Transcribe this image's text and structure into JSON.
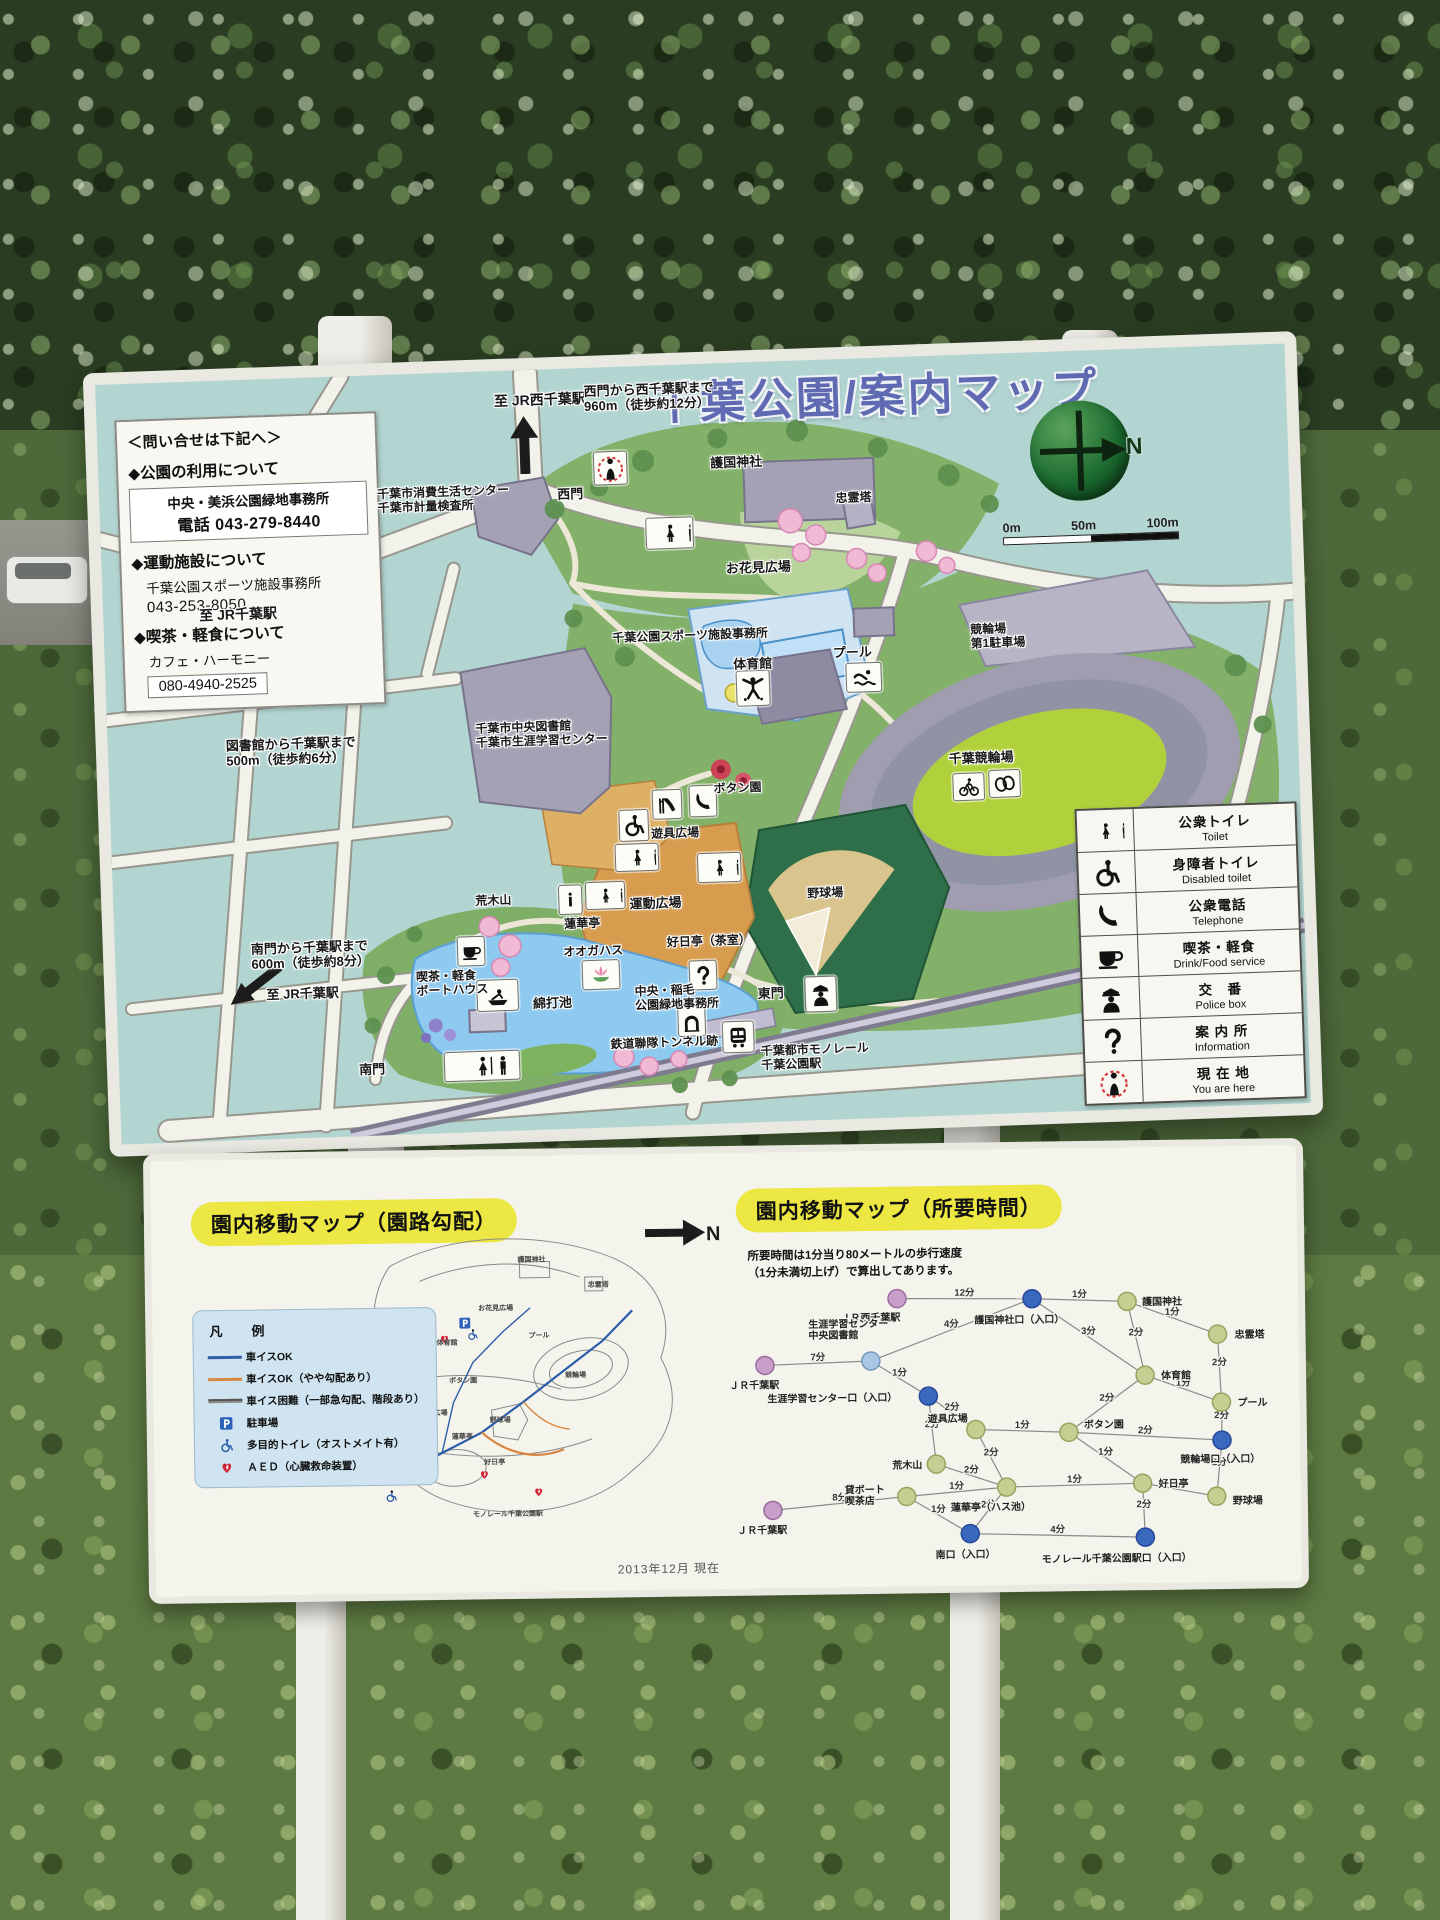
{
  "sign_title": "千葉公園/案内マップ",
  "compass_n": "N",
  "scale": [
    "0m",
    "50m",
    "100m"
  ],
  "contact": {
    "heading": "＜問い合せは下記へ＞",
    "s1_title": "◆公園の利用について",
    "s1_line1": "中央・美浜公園緑地事務所",
    "s1_line2": "電話 043-279-8440",
    "s2_title": "◆運動施設について",
    "s2_line1": "千葉公園スポーツ施設事務所",
    "s2_line2": "043-253-8050",
    "s3_title": "◆喫茶・軽食について",
    "s3_line1": "カフェ・ハーモニー",
    "s3_line2": "080-4940-2525"
  },
  "map_labels": [
    {
      "t": "至 JR西千葉駅",
      "x": 398,
      "y": 22,
      "fs": 14
    },
    {
      "t": "西門から西千葉駅まで\n960m（徒歩約12分）",
      "x": 488,
      "y": 16,
      "fs": 13
    },
    {
      "t": "西門",
      "x": 458,
      "y": 118,
      "fs": 13
    },
    {
      "t": "護国神社",
      "x": 612,
      "y": 92,
      "fs": 13
    },
    {
      "t": "忠霊塔",
      "x": 736,
      "y": 132,
      "fs": 12
    },
    {
      "t": "お花見広場",
      "x": 624,
      "y": 198,
      "fs": 13
    },
    {
      "t": "千葉市消費生活センター\n千葉市計量検査所",
      "x": 278,
      "y": 112,
      "fs": 12
    },
    {
      "t": "千葉公園スポーツ施設事務所",
      "x": 508,
      "y": 264,
      "fs": 12
    },
    {
      "t": "体育館",
      "x": 628,
      "y": 294,
      "fs": 13
    },
    {
      "t": "プール",
      "x": 728,
      "y": 286,
      "fs": 13
    },
    {
      "t": "競輪場\n第1駐車場",
      "x": 866,
      "y": 268,
      "fs": 12
    },
    {
      "t": "千葉競輪場",
      "x": 840,
      "y": 396,
      "fs": 13
    },
    {
      "t": "ボタン園",
      "x": 604,
      "y": 418,
      "fs": 12
    },
    {
      "t": "遊具広場",
      "x": 540,
      "y": 461,
      "fs": 12
    },
    {
      "t": "運動広場",
      "x": 516,
      "y": 530,
      "fs": 13
    },
    {
      "t": "野球場",
      "x": 694,
      "y": 526,
      "fs": 12
    },
    {
      "t": "荒木山",
      "x": 362,
      "y": 522,
      "fs": 12
    },
    {
      "t": "蓮華亭",
      "x": 450,
      "y": 548,
      "fs": 12
    },
    {
      "t": "オオガハス",
      "x": 448,
      "y": 576,
      "fs": 12
    },
    {
      "t": "好日亭（茶室）",
      "x": 552,
      "y": 570,
      "fs": 12
    },
    {
      "t": "喫茶・軽食\nボートハウス",
      "x": 300,
      "y": 596,
      "fs": 12
    },
    {
      "t": "綿打池",
      "x": 416,
      "y": 626,
      "fs": 13
    },
    {
      "t": "中央・稲毛\n公園緑地事務所",
      "x": 518,
      "y": 618,
      "fs": 12
    },
    {
      "t": "東門",
      "x": 641,
      "y": 624,
      "fs": 13
    },
    {
      "t": "鉄道聯隊トンネル跡",
      "x": 492,
      "y": 670,
      "fs": 12
    },
    {
      "t": "千葉都市モノレール\n千葉公園駅",
      "x": 642,
      "y": 682,
      "fs": 12
    },
    {
      "t": "南門",
      "x": 240,
      "y": 686,
      "fs": 13
    },
    {
      "t": "図書館から千葉駅まで\n500m（徒歩約6分）",
      "x": 118,
      "y": 358,
      "fs": 13
    },
    {
      "t": "至 JR千葉駅",
      "x": 96,
      "y": 226,
      "fs": 14
    },
    {
      "t": "南門から千葉駅まで\n600m（徒歩約8分）",
      "x": 136,
      "y": 562,
      "fs": 13
    },
    {
      "t": "至 JR千葉駅",
      "x": 150,
      "y": 608,
      "fs": 13
    },
    {
      "t": "千葉市中央図書館\n千葉市生涯学習センター",
      "x": 368,
      "y": 350,
      "fs": 12
    }
  ],
  "legend": {
    "rows": [
      {
        "icon": "toilet-icon",
        "jp": "公衆トイレ",
        "en": "Toilet"
      },
      {
        "icon": "disabled-toilet-icon",
        "jp": "身障者トイレ",
        "en": "Disabled toilet"
      },
      {
        "icon": "telephone-icon",
        "jp": "公衆電話",
        "en": "Telephone"
      },
      {
        "icon": "drink-food-icon",
        "jp": "喫茶・軽食",
        "en": "Drink/Food service"
      },
      {
        "icon": "police-box-icon",
        "jp": "交　番",
        "en": "Police box"
      },
      {
        "icon": "information-icon",
        "jp": "案 内 所",
        "en": "Information"
      },
      {
        "icon": "you-are-here-icon",
        "jp": "現 在 地",
        "en": "You are here"
      }
    ]
  },
  "bottom": {
    "grad_title": "園内移動マップ（園路勾配）",
    "time_title": "園内移動マップ（所要時間）",
    "north_label": "N",
    "legend_heading": "凡　例",
    "legend_items": [
      "車イスOK",
      "車イスOK（やや勾配あり）",
      "車イス困難（一部急勾配、階段あり）",
      "駐車場",
      "多目的トイレ（オストメイト有）",
      "ＡＥＤ（心臓救命装置）"
    ],
    "time_note1": "所要時間は1分当り80メートルの歩行速度",
    "time_note2": "（1分未満切上げ）で算出してあります。",
    "date_note": "2013年12月 現在",
    "mini_labels": [
      {
        "t": "護国神社",
        "x": 188,
        "y": 42
      },
      {
        "t": "忠霊塔",
        "x": 258,
        "y": 68
      },
      {
        "t": "お花見広場",
        "x": 148,
        "y": 90
      },
      {
        "t": "体育館",
        "x": 106,
        "y": 124
      },
      {
        "t": "プール",
        "x": 198,
        "y": 118
      },
      {
        "t": "ボタン園",
        "x": 118,
        "y": 162
      },
      {
        "t": "競輪場",
        "x": 234,
        "y": 158
      },
      {
        "t": "運動広場",
        "x": 88,
        "y": 194
      },
      {
        "t": "野球場",
        "x": 158,
        "y": 202
      },
      {
        "t": "蓮華亭",
        "x": 120,
        "y": 218
      },
      {
        "t": "綿打池",
        "x": 76,
        "y": 250
      },
      {
        "t": "好日亭",
        "x": 152,
        "y": 244
      },
      {
        "t": "荒木山",
        "x": 38,
        "y": 220
      },
      {
        "t": "モノレール千葉公園駅",
        "x": 140,
        "y": 296
      }
    ],
    "network": {
      "nodes": [
        {
          "id": "jrw",
          "label": "ＪＲ西千葉駅",
          "type": "station",
          "x": 185,
          "y": 30,
          "lx": 128,
          "ly": 52
        },
        {
          "id": "ggu",
          "label": "護国神社口（入口）",
          "type": "entrance",
          "x": 320,
          "y": 32,
          "lx": 262,
          "ly": 56
        },
        {
          "id": "gok",
          "label": "護国神社",
          "type": "facility",
          "x": 415,
          "y": 36,
          "lx": 430,
          "ly": 40
        },
        {
          "id": "chu",
          "label": "忠霊塔",
          "type": "facility",
          "x": 505,
          "y": 70,
          "lx": 522,
          "ly": 74
        },
        {
          "id": "jc1",
          "label": "ＪＲ千葉駅",
          "type": "station",
          "x": 52,
          "y": 95,
          "lx": 16,
          "ly": 118
        },
        {
          "id": "gak",
          "label": "生涯学習センター\n中央図書館",
          "type": "landmark",
          "x": 158,
          "y": 92,
          "lx": 96,
          "ly": 58
        },
        {
          "id": "ggu2",
          "label": "生涯学習センター口（入口）",
          "type": "entrance",
          "x": 215,
          "y": 128,
          "lx": 54,
          "ly": 132
        },
        {
          "id": "tai",
          "label": "体育館",
          "type": "facility",
          "x": 432,
          "y": 110,
          "lx": 448,
          "ly": 114
        },
        {
          "id": "poo",
          "label": "プール",
          "type": "facility",
          "x": 508,
          "y": 138,
          "lx": 524,
          "ly": 142
        },
        {
          "id": "yug",
          "label": "遊具広場",
          "type": "facility",
          "x": 262,
          "y": 162,
          "lx": 214,
          "ly": 154
        },
        {
          "id": "bot",
          "label": "ボタン園",
          "type": "facility",
          "x": 355,
          "y": 166,
          "lx": 370,
          "ly": 162
        },
        {
          "id": "kei",
          "label": "競輪場口（入口）",
          "type": "entrance",
          "x": 508,
          "y": 176,
          "lx": 466,
          "ly": 198
        },
        {
          "id": "ara",
          "label": "荒木山",
          "type": "facility",
          "x": 222,
          "y": 196,
          "lx": 178,
          "ly": 200
        },
        {
          "id": "ren",
          "label": "蓮華亭（ハス池）",
          "type": "facility",
          "x": 292,
          "y": 220,
          "lx": 236,
          "ly": 243
        },
        {
          "id": "koj",
          "label": "好日亭",
          "type": "facility",
          "x": 428,
          "y": 218,
          "lx": 444,
          "ly": 222
        },
        {
          "id": "yak",
          "label": "野球場",
          "type": "facility",
          "x": 502,
          "y": 232,
          "lx": 518,
          "ly": 240
        },
        {
          "id": "boa",
          "label": "貸ボート\n喫茶店",
          "type": "facility",
          "x": 192,
          "y": 228,
          "lx": 130,
          "ly": 224
        },
        {
          "id": "jc2",
          "label": "ＪＲ千葉駅",
          "type": "station",
          "x": 58,
          "y": 240,
          "lx": 22,
          "ly": 263
        },
        {
          "id": "min",
          "label": "南口（入口）",
          "type": "entrance",
          "x": 255,
          "y": 266,
          "lx": 220,
          "ly": 290
        },
        {
          "id": "mon",
          "label": "モノレール千葉公園駅口（入口）",
          "type": "entrance",
          "x": 430,
          "y": 272,
          "lx": 326,
          "ly": 296
        }
      ],
      "edges": [
        {
          "a": "jrw",
          "b": "ggu",
          "m": "12分"
        },
        {
          "a": "ggu",
          "b": "gok",
          "m": "1分"
        },
        {
          "a": "gok",
          "b": "chu",
          "m": "1分"
        },
        {
          "a": "ggu",
          "b": "tai",
          "m": "3分"
        },
        {
          "a": "gok",
          "b": "tai",
          "m": "2分"
        },
        {
          "a": "chu",
          "b": "poo",
          "m": "2分"
        },
        {
          "a": "tai",
          "b": "poo",
          "m": "1分"
        },
        {
          "a": "jc1",
          "b": "gak",
          "m": "7分"
        },
        {
          "a": "gak",
          "b": "ggu2",
          "m": "1分"
        },
        {
          "a": "gak",
          "b": "ggu",
          "m": "4分"
        },
        {
          "a": "ggu2",
          "b": "yug",
          "m": "2分"
        },
        {
          "a": "ggu2",
          "b": "ara",
          "m": "2分"
        },
        {
          "a": "yug",
          "b": "bot",
          "m": "1分"
        },
        {
          "a": "bot",
          "b": "tai",
          "m": "2分"
        },
        {
          "a": "bot",
          "b": "kei",
          "m": "2分"
        },
        {
          "a": "bot",
          "b": "koj",
          "m": "1分"
        },
        {
          "a": "yug",
          "b": "ren",
          "m": "2分"
        },
        {
          "a": "ara",
          "b": "ren",
          "m": "2分"
        },
        {
          "a": "ren",
          "b": "koj",
          "m": "1分"
        },
        {
          "a": "ren",
          "b": "boa",
          "m": "1分"
        },
        {
          "a": "koj",
          "b": "yak",
          "m": "1分"
        },
        {
          "a": "kei",
          "b": "yak",
          "m": "2分"
        },
        {
          "a": "poo",
          "b": "kei",
          "m": "2分"
        },
        {
          "a": "boa",
          "b": "jc2",
          "m": "8分"
        },
        {
          "a": "boa",
          "b": "min",
          "m": "1分"
        },
        {
          "a": "min",
          "b": "mon",
          "m": "4分"
        },
        {
          "a": "koj",
          "b": "mon",
          "m": "2分"
        },
        {
          "a": "ren",
          "b": "min",
          "m": "2分"
        }
      ]
    }
  }
}
